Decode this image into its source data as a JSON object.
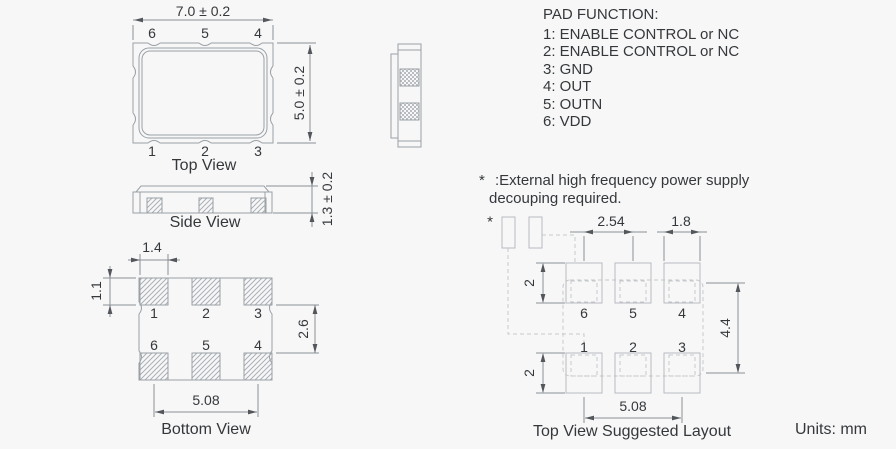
{
  "top_view": {
    "caption": "Top View",
    "dim_width": "7.0 ± 0.2",
    "dim_height": "5.0 ± 0.2",
    "pins_top": [
      "6",
      "5",
      "4"
    ],
    "pins_bottom": [
      "1",
      "2",
      "3"
    ]
  },
  "side_view": {
    "caption": "Side View",
    "dim_thickness": "1.3 ± 0.2"
  },
  "bottom_view": {
    "caption": "Bottom View",
    "dim_pad_width": "1.4",
    "dim_pad_height": "1.1",
    "dim_row_gap": "2.6",
    "dim_pad_span": "5.08",
    "pins_top": [
      "1",
      "2",
      "3"
    ],
    "pins_bottom": [
      "6",
      "5",
      "4"
    ]
  },
  "pad_function": {
    "title": "PAD FUNCTION:",
    "items": [
      "1: ENABLE CONTROL or NC",
      "2: ENABLE CONTROL or NC",
      "3: GND",
      "4: OUT",
      "5: OUTN",
      "6: VDD"
    ]
  },
  "note": {
    "marker": "*",
    "line1": ":External high frequency power supply",
    "line2": "decouping required."
  },
  "layout_view": {
    "caption": "Top View Suggested Layout",
    "decoupling_marker": "*",
    "dim_pitch": "2.54",
    "dim_pad_width": "1.8",
    "dim_pad_height_top": "2",
    "dim_pad_height_bottom": "2",
    "dim_row_span": "4.4",
    "dim_pad_span": "5.08",
    "pins_top": [
      "6",
      "5",
      "4"
    ],
    "pins_bottom": [
      "1",
      "2",
      "3"
    ]
  },
  "units_label": "Units: mm",
  "colors": {
    "background": "#f7f7f8",
    "outline": "#9aa0a5",
    "layout_outline": "#b7bbbf",
    "dimension": "#8b9096",
    "text": "#35383b"
  }
}
